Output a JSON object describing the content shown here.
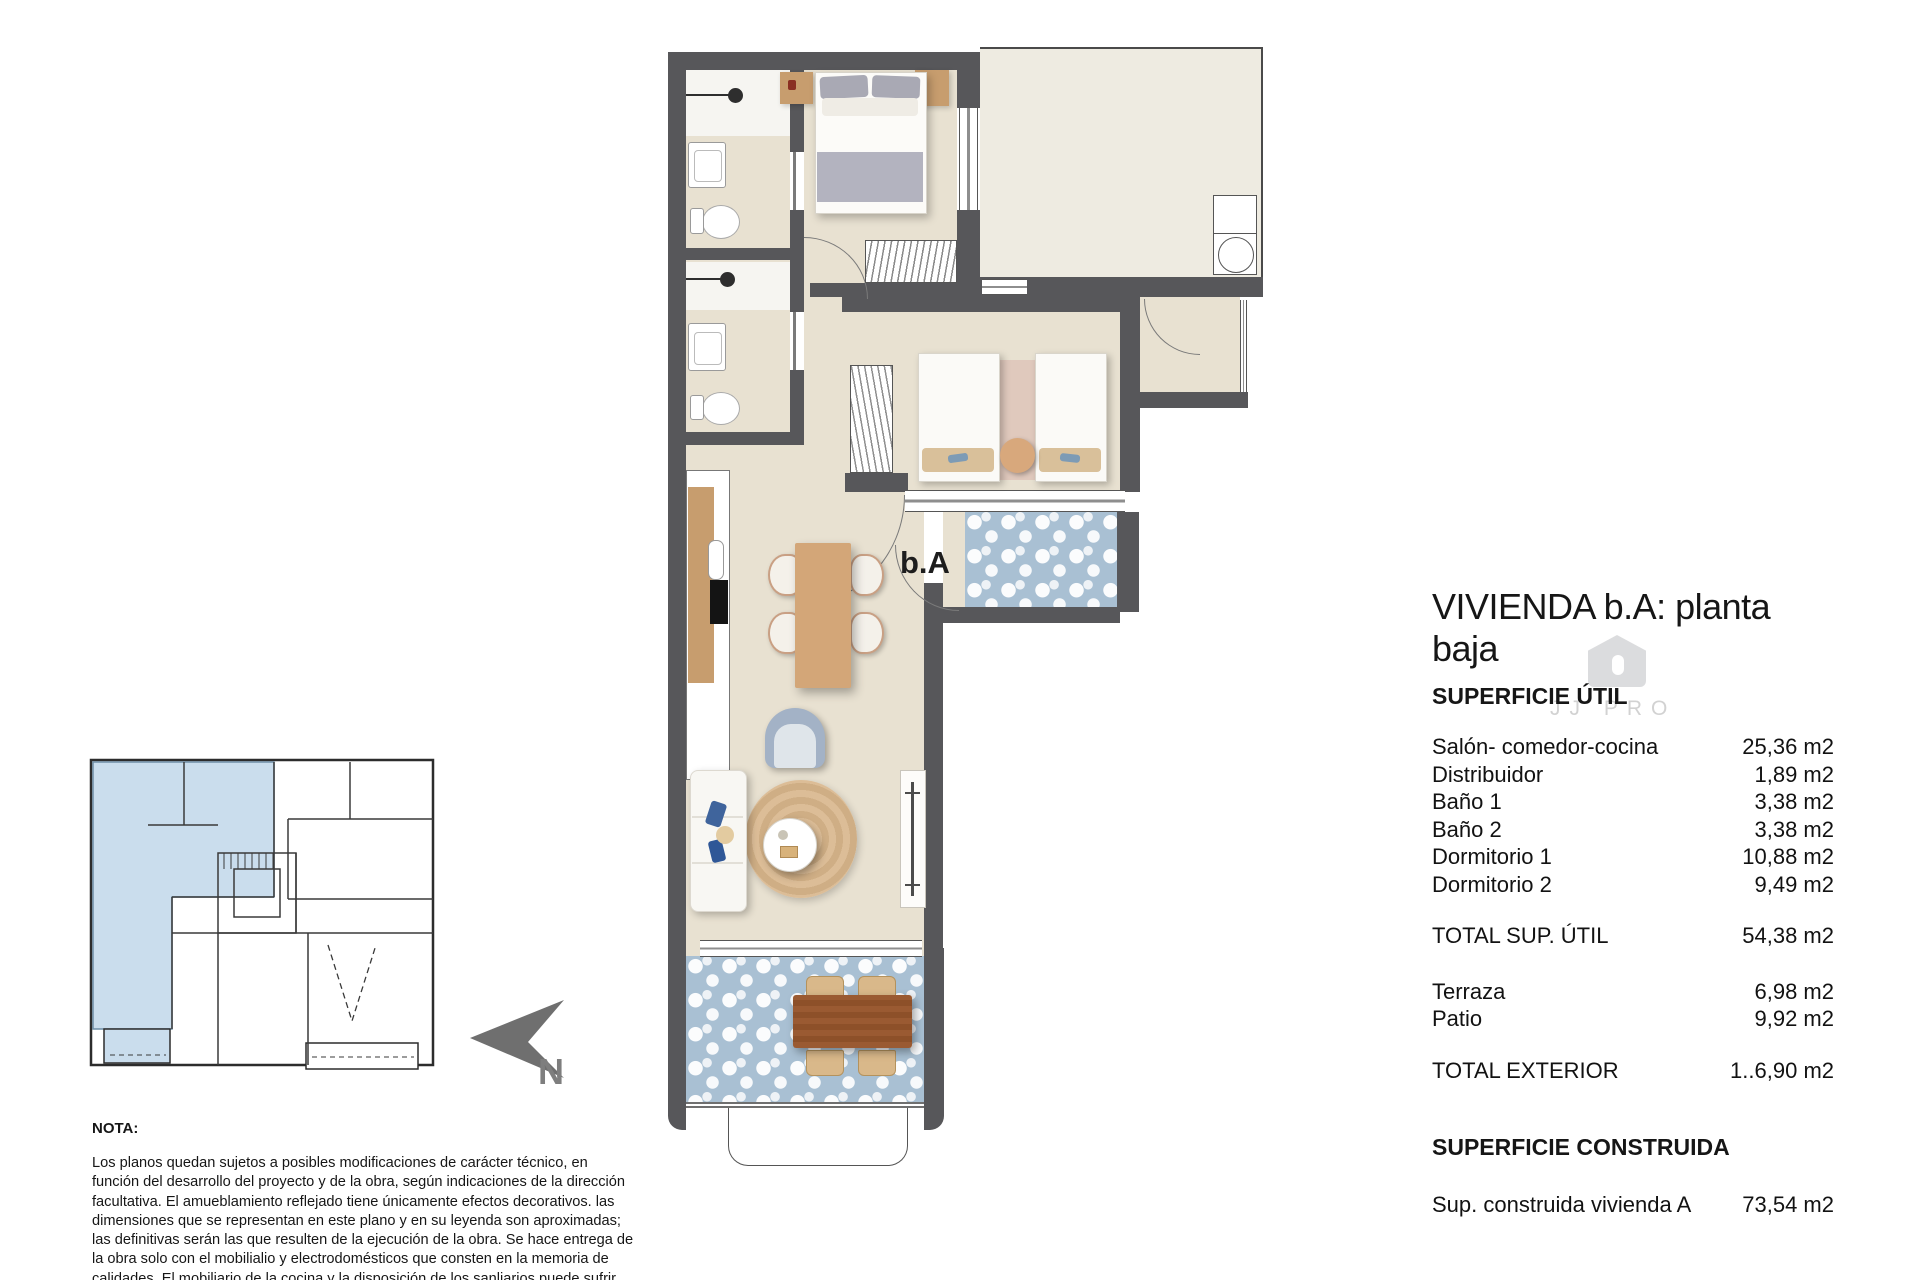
{
  "plan": {
    "unit_label": "b.A",
    "watermark": "JJ PRO"
  },
  "north": {
    "label": "N"
  },
  "panel": {
    "title": "VIVIENDA b.A: planta baja",
    "section_util": "SUPERFICIE ÚTIL",
    "rows": [
      {
        "label": "Salón- comedor-cocina",
        "value": "25,36 m2"
      },
      {
        "label": "Distribuidor",
        "value": "1,89 m2"
      },
      {
        "label": "Baño 1",
        "value": "3,38 m2"
      },
      {
        "label": "Baño 2",
        "value": "3,38 m2"
      },
      {
        "label": "Dormitorio 1",
        "value": "10,88 m2"
      },
      {
        "label": "Dormitorio 2",
        "value": "9,49 m2"
      }
    ],
    "total_util": {
      "label": "TOTAL SUP. ÚTIL",
      "value": "54,38 m2"
    },
    "exterior_rows": [
      {
        "label": "Terraza",
        "value": "6,98 m2"
      },
      {
        "label": "Patio",
        "value": "9,92 m2"
      }
    ],
    "total_exterior": {
      "label": "TOTAL EXTERIOR",
      "value": "1..6,90 m2"
    },
    "section_construida": "SUPERFICIE CONSTRUIDA",
    "constructed": {
      "label": "Sup. construida vivienda A",
      "value": "73,54 m2"
    }
  },
  "nota": {
    "heading": "NOTA:",
    "body": "Los planos quedan sujetos a posibles modificaciones de carácter técnico, en función del desarrollo del proyecto y de la obra, según indicaciones de la dirección facultativa. El amueblamiento reflejado tiene únicamente efectos decorativos. las dimensiones que se representan en este plano y en su leyenda son aproximadas; las definitivas serán las que resulten de la ejecución de la obra. Se hace entrega de la obra solo con el mobilialio y electrodomésticos que consten en la memoria de calidades. El mobiliario de la cocina y la disposición de los sanliarios puede sufrir ligeras variaciones en función del montaje definitivo."
  },
  "colors": {
    "wall": "#57575a",
    "floor": "#e8e1d1",
    "patio_floor": "#eeebe1",
    "tile_blue": "#a9c0d3",
    "keyplan_highlight": "#cadded",
    "wood": "#c79d6e",
    "wood_dark": "#9a5a32",
    "rug": "#d7b690"
  }
}
